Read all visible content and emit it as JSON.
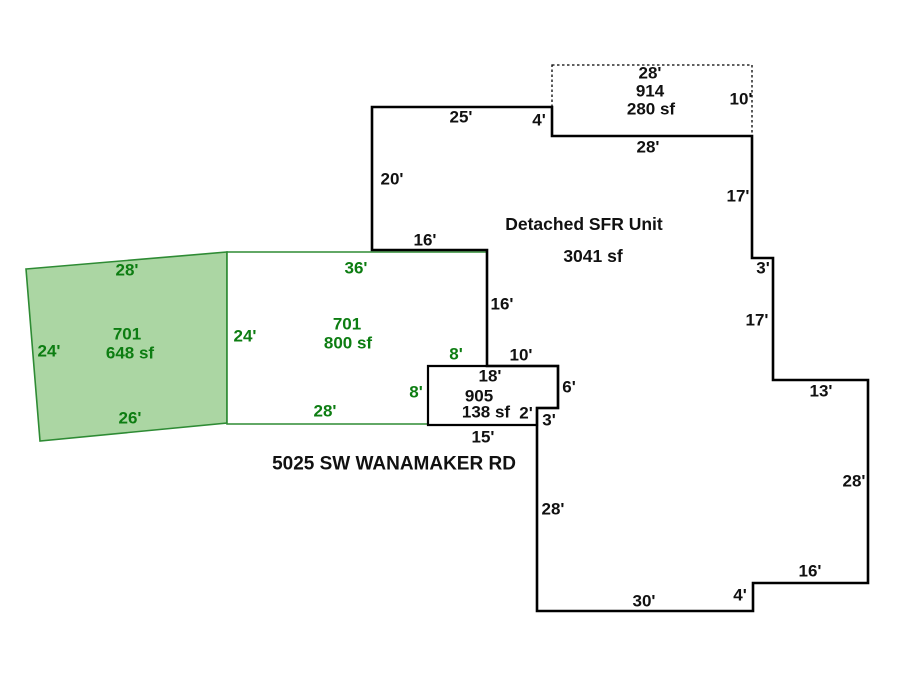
{
  "address": "5025 SW WANAMAKER RD",
  "units": [
    {
      "id": "701",
      "area": "648 sf"
    },
    {
      "id": "701",
      "area": "800 sf"
    },
    {
      "id": "905",
      "area": "138 sf"
    },
    {
      "id": "914",
      "area": "280 sf"
    },
    {
      "id": "Detached SFR Unit",
      "area": "3041 sf"
    }
  ],
  "colors": {
    "background": "#ffffff",
    "green_fill": "#abd6a3",
    "green_line": "#2e8b34",
    "green_text": "#0d7d12",
    "black_line": "#000000",
    "black_text": "#111111",
    "white_fill": "#ffffff"
  },
  "sketch": {
    "width": 900,
    "height": 675,
    "shapes": [
      {
        "name": "unit-701-648sf-shape",
        "points": [
          [
            26,
            269
          ],
          [
            227,
            252
          ],
          [
            227,
            423
          ],
          [
            40,
            441
          ]
        ],
        "fill": "green_fill",
        "stroke": "green_line",
        "stroke_width": 1.6,
        "dashed": false
      },
      {
        "name": "unit-701-800sf-shape",
        "points": [
          [
            227,
            252
          ],
          [
            487,
            252
          ],
          [
            487,
            366
          ],
          [
            428,
            366
          ],
          [
            428,
            424
          ],
          [
            227,
            424
          ]
        ],
        "fill": "white_fill",
        "stroke": "green_line",
        "stroke_width": 1.6,
        "dashed": false
      },
      {
        "name": "unit-905-shape",
        "points": [
          [
            428,
            366
          ],
          [
            558,
            366
          ],
          [
            558,
            408
          ],
          [
            537,
            408
          ],
          [
            537,
            425
          ],
          [
            428,
            425
          ]
        ],
        "fill": "white_fill",
        "stroke": "black_line",
        "stroke_width": 2.2,
        "dashed": false
      },
      {
        "name": "unit-914-dotted-shape",
        "points": [
          [
            552,
            65
          ],
          [
            752,
            65
          ],
          [
            752,
            136
          ],
          [
            552,
            136
          ]
        ],
        "fill": "none",
        "stroke": "black_line",
        "stroke_width": 1.3,
        "dashed": true
      },
      {
        "name": "detached-sfr-outline",
        "points": [
          [
            372,
            107
          ],
          [
            552,
            107
          ],
          [
            552,
            136
          ],
          [
            752,
            136
          ],
          [
            752,
            258
          ],
          [
            773,
            258
          ],
          [
            773,
            380
          ],
          [
            868,
            380
          ],
          [
            868,
            583
          ],
          [
            753,
            583
          ],
          [
            753,
            611
          ],
          [
            537,
            611
          ],
          [
            537,
            408
          ],
          [
            558,
            408
          ],
          [
            558,
            366
          ],
          [
            487,
            366
          ],
          [
            487,
            250
          ],
          [
            372,
            250
          ]
        ],
        "fill": "none",
        "stroke": "black_line",
        "stroke_width": 2.6,
        "dashed": false
      }
    ],
    "labels": [
      {
        "name": "dim-701a-top-28",
        "text": "28'",
        "x": 127,
        "y": 270,
        "color": "green"
      },
      {
        "name": "dim-701a-left-24",
        "text": "24'",
        "x": 49,
        "y": 351,
        "color": "green"
      },
      {
        "name": "unit-701a-id",
        "text": "701",
        "x": 127,
        "y": 334,
        "color": "green"
      },
      {
        "name": "unit-701a-area",
        "text": "648 sf",
        "x": 130,
        "y": 353,
        "color": "green"
      },
      {
        "name": "dim-701a-bottom-26",
        "text": "26'",
        "x": 130,
        "y": 418,
        "color": "green"
      },
      {
        "name": "dim-701b-left-24",
        "text": "24'",
        "x": 245,
        "y": 336,
        "color": "green"
      },
      {
        "name": "dim-701b-top-36",
        "text": "36'",
        "x": 356,
        "y": 268,
        "color": "green"
      },
      {
        "name": "unit-701b-id",
        "text": "701",
        "x": 347,
        "y": 324,
        "color": "green"
      },
      {
        "name": "unit-701b-area",
        "text": "800 sf",
        "x": 348,
        "y": 343,
        "color": "green"
      },
      {
        "name": "dim-701b-step-top-8",
        "text": "8'",
        "x": 456,
        "y": 354,
        "color": "green"
      },
      {
        "name": "dim-701b-step-side-8",
        "text": "8'",
        "x": 416,
        "y": 392,
        "color": "green"
      },
      {
        "name": "dim-701b-bottom-28",
        "text": "28'",
        "x": 325,
        "y": 411,
        "color": "green"
      },
      {
        "name": "dim-sfr-top-25",
        "text": "25'",
        "x": 461,
        "y": 117,
        "color": "black"
      },
      {
        "name": "dim-sfr-step-4",
        "text": "4'",
        "x": 539,
        "y": 120,
        "color": "black"
      },
      {
        "name": "dim-sfr-left-20",
        "text": "20'",
        "x": 392,
        "y": 179,
        "color": "black"
      },
      {
        "name": "dim-sfr-notch-16",
        "text": "16'",
        "x": 425,
        "y": 240,
        "color": "black"
      },
      {
        "name": "dim-914-top-28",
        "text": "28'",
        "x": 650,
        "y": 73,
        "color": "black"
      },
      {
        "name": "unit-914-id",
        "text": "914",
        "x": 650,
        "y": 91,
        "color": "black"
      },
      {
        "name": "unit-914-area",
        "text": "280 sf",
        "x": 651,
        "y": 109,
        "color": "black"
      },
      {
        "name": "dim-914-right-10",
        "text": "10'",
        "x": 741,
        "y": 99,
        "color": "black"
      },
      {
        "name": "dim-sfr-upper-28",
        "text": "28'",
        "x": 648,
        "y": 147,
        "color": "black"
      },
      {
        "name": "dim-sfr-right-17a",
        "text": "17'",
        "x": 738,
        "y": 196,
        "color": "black"
      },
      {
        "name": "unit-sfr-name",
        "text": "Detached SFR Unit",
        "x": 584,
        "y": 224,
        "color": "black",
        "size": 17.5
      },
      {
        "name": "unit-sfr-area",
        "text": "3041 sf",
        "x": 593,
        "y": 256,
        "color": "black",
        "size": 17.5
      },
      {
        "name": "dim-sfr-step-3",
        "text": "3'",
        "x": 763,
        "y": 268,
        "color": "black"
      },
      {
        "name": "dim-sfr-right-17b",
        "text": "17'",
        "x": 757,
        "y": 320,
        "color": "black"
      },
      {
        "name": "dim-sfr-inner-16",
        "text": "16'",
        "x": 502,
        "y": 304,
        "color": "black"
      },
      {
        "name": "dim-905-top-10",
        "text": "10'",
        "x": 521,
        "y": 355,
        "color": "black"
      },
      {
        "name": "dim-905-top-18",
        "text": "18'",
        "x": 490,
        "y": 376,
        "color": "black"
      },
      {
        "name": "dim-905-right-6",
        "text": "6'",
        "x": 569,
        "y": 387,
        "color": "black"
      },
      {
        "name": "unit-905-id",
        "text": "905",
        "x": 479,
        "y": 396,
        "color": "black"
      },
      {
        "name": "unit-905-area",
        "text": "138 sf",
        "x": 486,
        "y": 412,
        "color": "black"
      },
      {
        "name": "dim-905-step-2",
        "text": "2'",
        "x": 526,
        "y": 413,
        "color": "black"
      },
      {
        "name": "dim-905-step-3",
        "text": "3'",
        "x": 549,
        "y": 420,
        "color": "black"
      },
      {
        "name": "dim-905-bottom-15",
        "text": "15'",
        "x": 483,
        "y": 437,
        "color": "black"
      },
      {
        "name": "dim-sfr-mid-13",
        "text": "13'",
        "x": 821,
        "y": 391,
        "color": "black"
      },
      {
        "name": "dim-sfr-right-28",
        "text": "28'",
        "x": 854,
        "y": 481,
        "color": "black"
      },
      {
        "name": "dim-sfr-left-28",
        "text": "28'",
        "x": 553,
        "y": 509,
        "color": "black"
      },
      {
        "name": "dim-sfr-bottom-16",
        "text": "16'",
        "x": 810,
        "y": 571,
        "color": "black"
      },
      {
        "name": "dim-sfr-bottom-4",
        "text": "4'",
        "x": 740,
        "y": 595,
        "color": "black"
      },
      {
        "name": "dim-sfr-bottom-30",
        "text": "30'",
        "x": 644,
        "y": 601,
        "color": "black"
      },
      {
        "name": "address-label",
        "text": "5025 SW WANAMAKER RD",
        "x": 394,
        "y": 464,
        "color": "black",
        "size": 19
      }
    ]
  }
}
